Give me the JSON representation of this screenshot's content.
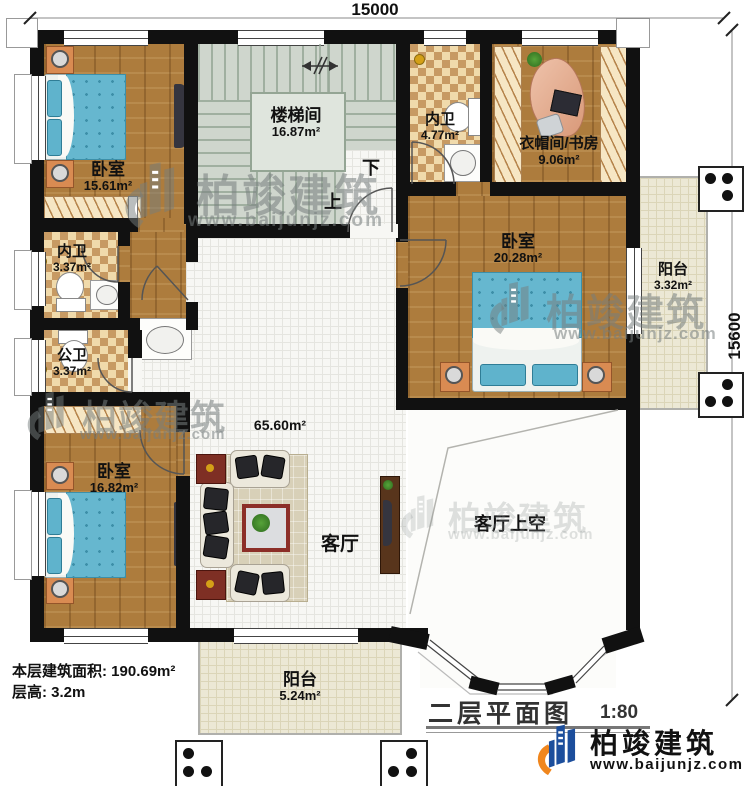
{
  "dimensions": {
    "top": "15000",
    "right": "15600"
  },
  "rooms": [
    {
      "name": "卧室",
      "area": "15.61m²"
    },
    {
      "name": "楼梯间",
      "area": "16.87m²"
    },
    {
      "name": "内卫",
      "area": "4.77m²"
    },
    {
      "name": "衣帽间/书房",
      "area": "9.06m²"
    },
    {
      "name": "内卫",
      "area": "3.37m²"
    },
    {
      "name": "公卫",
      "area": "3.37m²"
    },
    {
      "name": "卧室",
      "area": "20.28m²"
    },
    {
      "name": "阳台",
      "area": "3.32m²"
    },
    {
      "name": "卧室",
      "area": "16.82m²"
    },
    {
      "name": "客厅",
      "area": "65.60m²"
    },
    {
      "name": "客厅上空",
      "area": ""
    },
    {
      "name": "阳台",
      "area": "5.24m²"
    }
  ],
  "stairs": {
    "up": "上",
    "down": "下"
  },
  "info": {
    "floor_area": "本层建筑面积: 190.69m²",
    "floor_height": "层高: 3.2m"
  },
  "title": {
    "text": "二层平面图",
    "scale": "1:80"
  },
  "branding": {
    "company": "柏竣建筑",
    "website": "www.baijunjz.com"
  },
  "watermark": {
    "company": "柏竣建筑",
    "website": "www.baijunjz.com"
  },
  "colors": {
    "wall": "#111111",
    "wood": "#ad7c3d",
    "checker_dark": "#c79a63",
    "bed_blue": "#66b7cf",
    "balcony": "#ece8d5",
    "logo_blue": "#1c4e9c",
    "logo_orange": "#f0861d"
  }
}
